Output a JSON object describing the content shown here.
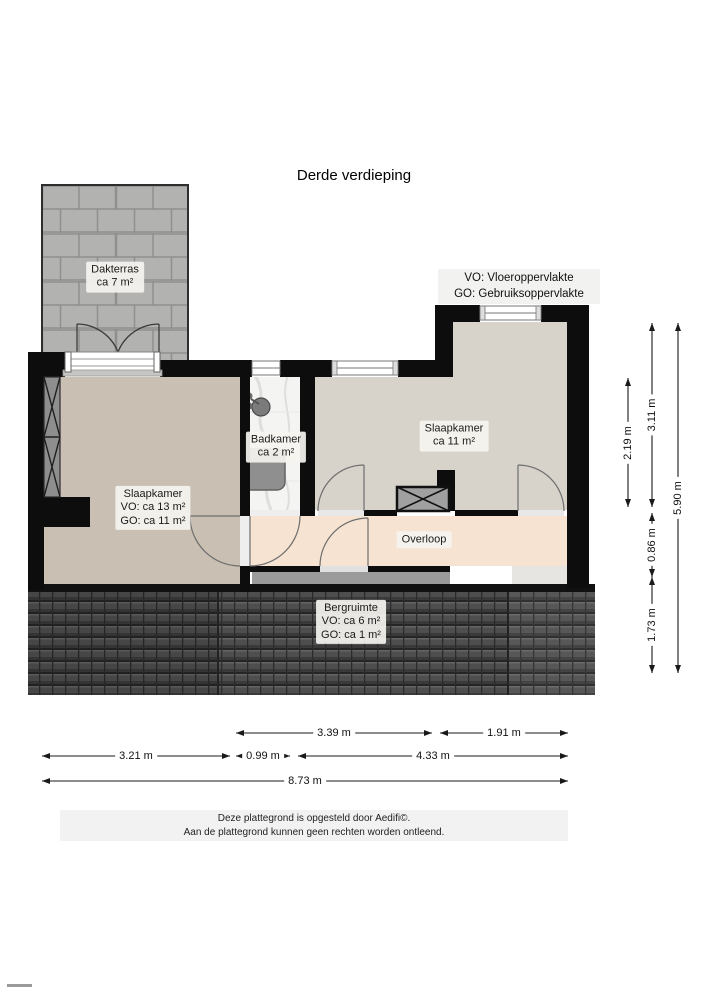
{
  "title": "Derde verdieping",
  "legend": {
    "vo": "VO: Vloeroppervlakte",
    "go": "GO: Gebruiksoppervlakte"
  },
  "rooms": {
    "dakterras": {
      "name": "Dakterras",
      "area": "ca 7 m²"
    },
    "slaapkamer_left": {
      "name": "Slaapkamer",
      "vo": "VO: ca 13 m²",
      "go": "GO: ca 11 m²"
    },
    "badkamer": {
      "name": "Badkamer",
      "area": "ca 2 m²"
    },
    "slaapkamer_right": {
      "name": "Slaapkamer",
      "area": "ca 11 m²"
    },
    "overloop": {
      "name": "Overloop"
    },
    "bergruimte": {
      "name": "Bergruimte",
      "vo": "VO: ca 6 m²",
      "go": "GO: ca 1 m²"
    }
  },
  "dims": {
    "top_mid": "3.39 m",
    "top_right": "1.91 m",
    "mid_left": "3.21 m",
    "mid_center": "0.99 m",
    "mid_right": "4.33 m",
    "total_width": "8.73 m",
    "inner_height": "2.19 m",
    "upper_height": "3.11 m",
    "small_height": "0.86 m",
    "lower_height": "1.73 m",
    "total_height": "5.90 m"
  },
  "footer": {
    "line1": "Deze plattegrond is opgesteld door Aedifi©.",
    "line2": "Aan de plattegrond kunnen geen rechten worden ontleend."
  },
  "colors": {
    "wall": "#0d0d0d",
    "terrace_paving": "#b2b2b0",
    "bedroom_left_floor": "#c9bfb3",
    "bedroom_right_floor": "#d7d2ca",
    "hall_floor": "#f6e3d1",
    "roof_tiles": "#4a4a4a",
    "storage_gray": "#9b9b9b"
  }
}
